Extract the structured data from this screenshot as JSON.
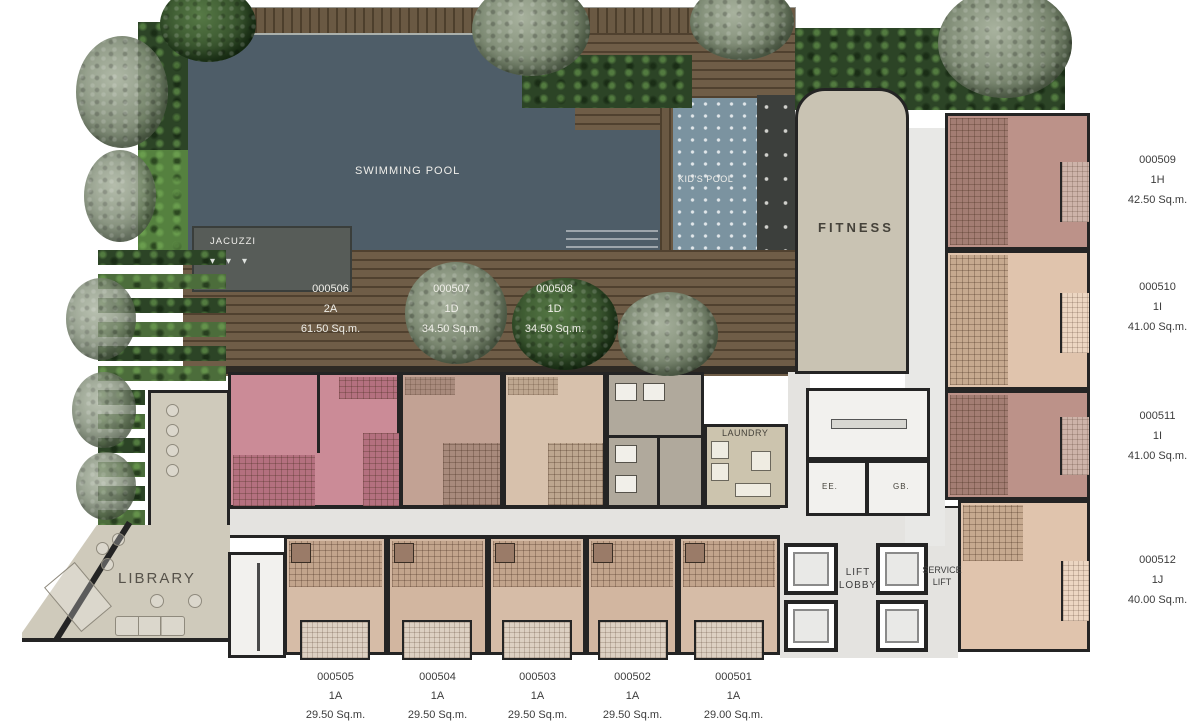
{
  "plan_labels": {
    "swimming_pool": "SWIMMING POOL",
    "kids_pool": "KID'S POOL",
    "jacuzzi": "JACUZZI",
    "fitness": "FITNESS",
    "laundry": "LAUNDRY",
    "library": "LIBRARY",
    "lift_lobby": "LIFT LOBBY",
    "service_lift": "SERVICE LIFT",
    "ee": "EE.",
    "gb": "GB."
  },
  "units": {
    "deck_row": [
      {
        "id": "000506",
        "type": "2A",
        "area": "61.50 Sq.m."
      },
      {
        "id": "000507",
        "type": "1D",
        "area": "34.50 Sq.m."
      },
      {
        "id": "000508",
        "type": "1D",
        "area": "34.50 Sq.m."
      }
    ],
    "right_column": [
      {
        "id": "000509",
        "type": "1H",
        "area": "42.50 Sq.m."
      },
      {
        "id": "000510",
        "type": "1I",
        "area": "41.00 Sq.m."
      },
      {
        "id": "000511",
        "type": "1I",
        "area": "41.00 Sq.m."
      },
      {
        "id": "000512",
        "type": "1J",
        "area": "40.00 Sq.m."
      }
    ],
    "bottom_row": [
      {
        "id": "000505",
        "type": "1A",
        "area": "29.50 Sq.m."
      },
      {
        "id": "000504",
        "type": "1A",
        "area": "29.50 Sq.m."
      },
      {
        "id": "000503",
        "type": "1A",
        "area": "29.50 Sq.m."
      },
      {
        "id": "000502",
        "type": "1A",
        "area": "29.50 Sq.m."
      },
      {
        "id": "000501",
        "type": "1A",
        "area": "29.00 Sq.m."
      }
    ]
  },
  "colors": {
    "pool_water": "#4e5d68",
    "kids_pool_water": "#7b93a0",
    "wood_deck": "#6f5d47",
    "jacuzzi": "#575c58",
    "fitness_floor": "#c9c3b3",
    "library_floor": "#cfcabb",
    "corridor": "#e4e3e0",
    "unit_pink": "#cb8b97",
    "unit_tan": "#c2a294",
    "unit_light_tan": "#d7c1ac",
    "unit_mauve": "#bc9289",
    "unit_peach": "#e0c4ad",
    "walls": "#242424",
    "hedge_green": "#2c4426",
    "label_text": "#3a3a3a"
  }
}
